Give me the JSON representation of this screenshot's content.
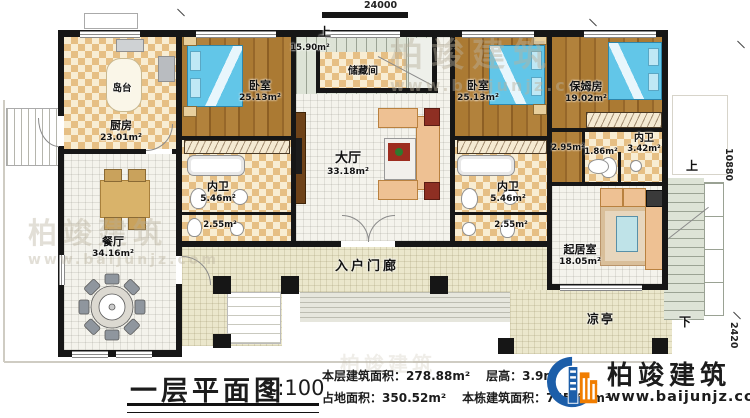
{
  "dimensions": {
    "top": "24000",
    "right": "10880",
    "bottom_right": "2420"
  },
  "stairs": {
    "up": "上",
    "down": "下"
  },
  "rooms": {
    "island": {
      "name": "岛台"
    },
    "kitchen": {
      "name": "厨房",
      "area": "23.01m²"
    },
    "bedroom_left": {
      "name": "卧室",
      "area": "25.13m²"
    },
    "storage": {
      "name": "储藏间",
      "area": "15.90m²"
    },
    "bedroom_right": {
      "name": "卧室",
      "area": "25.13m²"
    },
    "nanny_room": {
      "name": "保姆房",
      "area": "19.02m²"
    },
    "nanny_bath": {
      "name": "内卫",
      "area": "3.42m²"
    },
    "nanny_closet": {
      "area": "2.95m²"
    },
    "nanny_vestibule": {
      "area": "1.86m²"
    },
    "hall": {
      "name": "大厅",
      "area": "33.18m²"
    },
    "bath_left": {
      "name": "内卫",
      "area": "5.46m²"
    },
    "bath_right": {
      "name": "内卫",
      "area": "5.46m²"
    },
    "powder_left": {
      "area": "2.55m²"
    },
    "powder_right": {
      "area": "2.55m²"
    },
    "dining": {
      "name": "餐厅",
      "area": "34.16m²"
    },
    "living": {
      "name": "起居室",
      "area": "18.05m²"
    },
    "porch": {
      "name": "入户门廊"
    },
    "pavilion": {
      "name": "凉亭"
    }
  },
  "titleblock": {
    "title": "一层平面图",
    "scale": "1:100",
    "stats": [
      {
        "label": "本层建筑面积：",
        "value": "278.88m²"
      },
      {
        "label": "层高：",
        "value": "3.9m"
      },
      {
        "label": "占地面积：",
        "value": "350.52m²"
      },
      {
        "label": "本栋建筑面积：",
        "value": "745.64m²"
      }
    ]
  },
  "brand": {
    "name": "柏竣建筑",
    "url": "www.baijunjz.com"
  },
  "watermark": {
    "name": "柏竣建筑",
    "url": "www.baijunjz.com"
  },
  "colors": {
    "wall": "#161616",
    "brand_blue": "#1c5ea9",
    "brand_orange": "#f07d00",
    "check_dark": "#e6bf84",
    "check_light": "#f8edd3",
    "wood": "#a3722d",
    "porch": "#ebe7cc"
  }
}
